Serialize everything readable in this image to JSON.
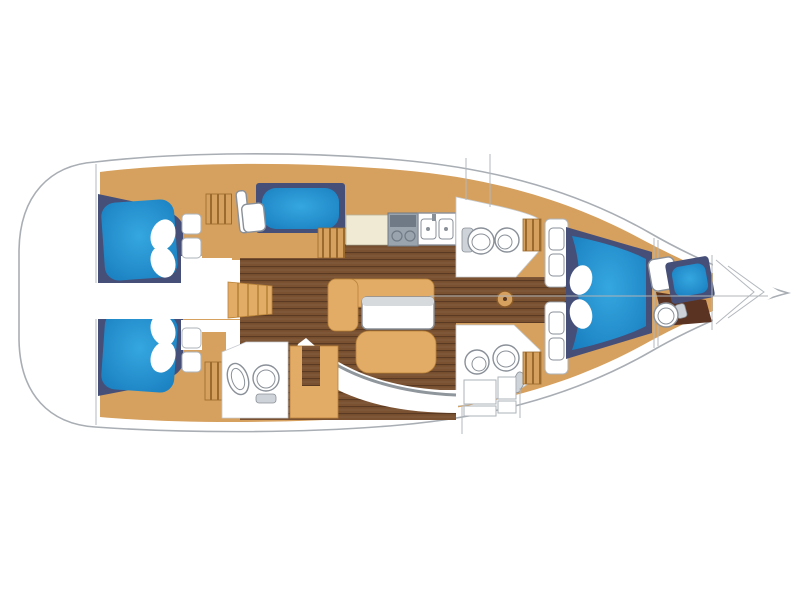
{
  "title": "Sailing yacht interior layout plan (top view, bow to the right)",
  "palette": {
    "page_background": "#ffffff",
    "hull_outline": "#a9aeb4",
    "deck_tan": "#d6a05e",
    "furniture_tan": "#e2ab66",
    "cushion_blue": "#35a7e0",
    "cushion_blue_edge": "#1a7fc0",
    "berth_trim_navy": "#454f78",
    "floor_wood": "#7a5232",
    "floor_plank_line": "#5a3a22",
    "counter_cream": "#f0ead4",
    "stove_gray": "#9aa4ae",
    "fixture_outline": "#8a9098",
    "settee_line": "#8f969c",
    "bow_floor_dark": "#5a3322"
  },
  "areas": [
    {
      "id": "swim-platform",
      "label": "stern platform"
    },
    {
      "id": "aft-cabin-port",
      "label": "aft double cabin (blue berth)"
    },
    {
      "id": "aft-cabin-starboard",
      "label": "aft double cabin (blue berth)"
    },
    {
      "id": "companionway",
      "label": "companionway with ladder"
    },
    {
      "id": "nav-station",
      "label": "navigation seat and berth"
    },
    {
      "id": "galley",
      "label": "galley with stove and double sink"
    },
    {
      "id": "saloon",
      "label": "saloon with table and curved settee"
    },
    {
      "id": "aft-head",
      "label": "aft head with toilet and sink"
    },
    {
      "id": "fwd-head-port",
      "label": "forward head with toilet and sink"
    },
    {
      "id": "fwd-head-starboard",
      "label": "forward head with toilet and sink"
    },
    {
      "id": "owner-cabin",
      "label": "forward owner cabin V-berth"
    },
    {
      "id": "crew-cabin",
      "label": "bow crew cabin with toilet"
    },
    {
      "id": "anchor-locker",
      "label": "anchor locker"
    }
  ]
}
